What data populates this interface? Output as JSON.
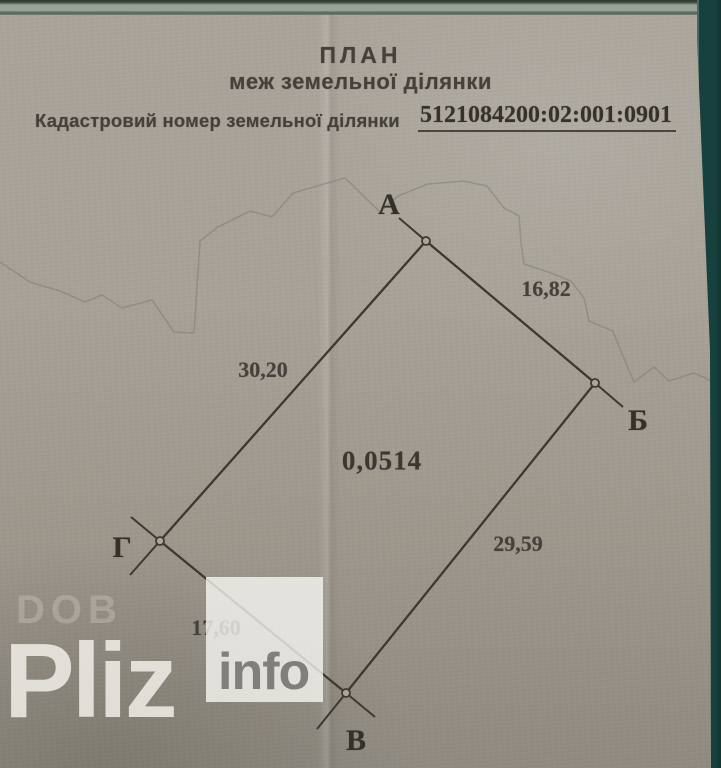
{
  "page": {
    "title_line1": "ПЛАН",
    "title_line2": "меж земельної ділянки",
    "cadastral_label": "Кадастровий номер земельної ділянки",
    "cadastral_number": "5121084200:02:001:0901"
  },
  "plot": {
    "area_value": "0,0514",
    "vertices": [
      {
        "name": "А"
      },
      {
        "name": "Б"
      },
      {
        "name": "В"
      },
      {
        "name": "Г"
      }
    ],
    "sides": [
      {
        "from": "А",
        "to": "Б",
        "length": "16,82"
      },
      {
        "from": "А",
        "to": "Г",
        "length": "30,20"
      },
      {
        "from": "Б",
        "to": "В",
        "length": "29,59"
      },
      {
        "from": "Г",
        "to": "В",
        "length": "17,60"
      }
    ]
  },
  "watermark": {
    "faint_text": "DOB",
    "brand": "Pliz",
    "suffix": "info"
  }
}
